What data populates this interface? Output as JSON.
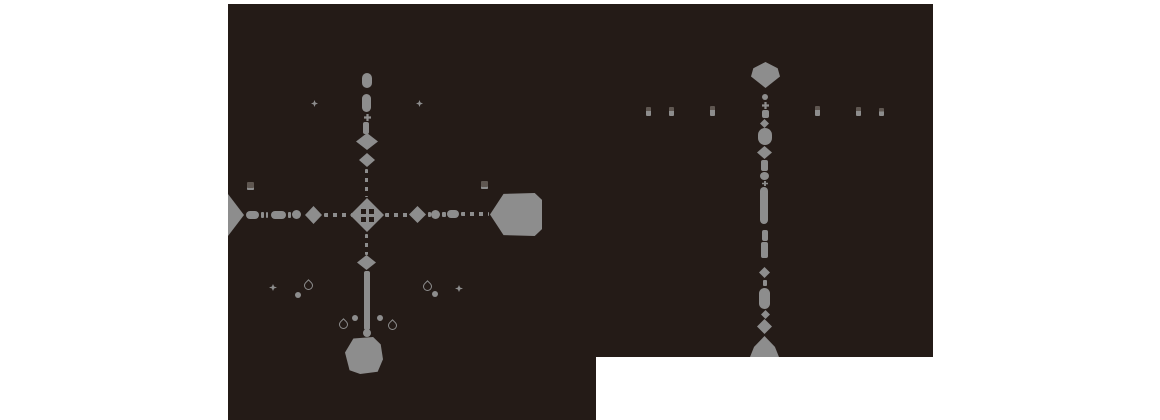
{
  "canvas": {
    "width": 1160,
    "height": 420
  },
  "colors": {
    "background": "#ffffff",
    "panel": "#241b17",
    "shape": "#8d8d8d",
    "dim": "#5f5751"
  },
  "panel": {
    "rects": [
      {
        "x": 228,
        "y": 4,
        "w": 705,
        "h": 353
      },
      {
        "x": 228,
        "y": 357,
        "w": 368,
        "h": 63
      }
    ]
  },
  "shapes": [
    {
      "t": "pill-v",
      "name": "left-route-north-terminal",
      "x": 362,
      "y": 73,
      "w": 10,
      "h": 15
    },
    {
      "t": "pill-v",
      "name": "left-route-segment",
      "x": 362,
      "y": 94,
      "w": 9,
      "h": 18
    },
    {
      "t": "plus",
      "name": "cross-node",
      "x": 364,
      "y": 114,
      "w": 7,
      "h": 7
    },
    {
      "t": "bar-v",
      "name": "left-route-segment",
      "x": 363,
      "y": 122,
      "w": 6,
      "h": 12
    },
    {
      "t": "diamond",
      "name": "route-node-diamond",
      "x": 356,
      "y": 133,
      "w": 22,
      "h": 17
    },
    {
      "t": "diamond",
      "name": "route-node-diamond",
      "x": 359,
      "y": 153,
      "w": 16,
      "h": 14
    },
    {
      "t": "dashes-v",
      "name": "dashed-path",
      "x": 365,
      "y": 169,
      "w": 3,
      "h": 28
    },
    {
      "t": "diamond-grid",
      "name": "left-route-center-junction",
      "x": 350,
      "y": 198,
      "w": 34,
      "h": 34
    },
    {
      "t": "dashes-v",
      "name": "dashed-path",
      "x": 365,
      "y": 234,
      "w": 3,
      "h": 21
    },
    {
      "t": "diamond",
      "name": "route-node-diamond",
      "x": 357,
      "y": 255,
      "w": 19,
      "h": 15
    },
    {
      "t": "bar-v",
      "name": "solid-path",
      "x": 364,
      "y": 271,
      "w": 6,
      "h": 59
    },
    {
      "t": "dot",
      "name": "route-node-dot",
      "x": 363,
      "y": 329,
      "w": 8,
      "h": 8
    },
    {
      "t": "tombstone",
      "name": "left-route-south-terminal",
      "x": 345,
      "y": 337,
      "w": 38,
      "h": 37
    },
    {
      "t": "tri-right",
      "name": "left-route-west-terminal",
      "x": 228,
      "y": 194,
      "w": 16,
      "h": 42
    },
    {
      "t": "pill-h",
      "name": "route-segment",
      "x": 246,
      "y": 211,
      "w": 13,
      "h": 8
    },
    {
      "t": "dash-h",
      "name": "route-dash",
      "x": 261,
      "y": 212,
      "w": 3,
      "h": 6
    },
    {
      "t": "dash-h",
      "name": "route-dash",
      "x": 266,
      "y": 212,
      "w": 2,
      "h": 6
    },
    {
      "t": "pill-h",
      "name": "route-segment",
      "x": 271,
      "y": 211,
      "w": 15,
      "h": 8
    },
    {
      "t": "dash-h",
      "name": "route-dash",
      "x": 288,
      "y": 212,
      "w": 3,
      "h": 6
    },
    {
      "t": "dot",
      "name": "route-node-dot",
      "x": 292,
      "y": 210,
      "w": 9,
      "h": 9
    },
    {
      "t": "diamond",
      "name": "route-node-diamond",
      "x": 305,
      "y": 206,
      "w": 17,
      "h": 18
    },
    {
      "t": "dashes-h",
      "name": "dashed-path",
      "x": 324,
      "y": 213,
      "w": 28,
      "h": 4
    },
    {
      "t": "dashes-h",
      "name": "dashed-path",
      "x": 385,
      "y": 213,
      "w": 24,
      "h": 4
    },
    {
      "t": "diamond",
      "name": "route-node-diamond",
      "x": 409,
      "y": 206,
      "w": 17,
      "h": 17
    },
    {
      "t": "dash-h",
      "name": "route-dash",
      "x": 428,
      "y": 212,
      "w": 3,
      "h": 5
    },
    {
      "t": "dot",
      "name": "route-node-dot",
      "x": 431,
      "y": 210,
      "w": 9,
      "h": 9
    },
    {
      "t": "dash-h",
      "name": "route-dash",
      "x": 442,
      "y": 212,
      "w": 4,
      "h": 5
    },
    {
      "t": "pill-h",
      "name": "route-segment",
      "x": 447,
      "y": 210,
      "w": 12,
      "h": 8
    },
    {
      "t": "dashes-h",
      "name": "dashed-path",
      "x": 461,
      "y": 212,
      "w": 28,
      "h": 4
    },
    {
      "t": "hex-left",
      "name": "left-route-east-terminal-hexagon",
      "x": 490,
      "y": 193,
      "w": 52,
      "h": 43
    },
    {
      "t": "star",
      "name": "star-marker-icon",
      "x": 311,
      "y": 100,
      "w": 7,
      "h": 7
    },
    {
      "t": "star",
      "name": "star-marker-icon",
      "x": 416,
      "y": 100,
      "w": 7,
      "h": 7
    },
    {
      "t": "building",
      "name": "building-marker-icon",
      "x": 247,
      "y": 182,
      "w": 7,
      "h": 8
    },
    {
      "t": "building",
      "name": "building-marker-icon",
      "x": 481,
      "y": 181,
      "w": 7,
      "h": 8
    },
    {
      "t": "star",
      "name": "star-marker-icon",
      "x": 269,
      "y": 284,
      "w": 8,
      "h": 7
    },
    {
      "t": "dot-s",
      "name": "dot-marker-icon",
      "x": 295,
      "y": 292,
      "w": 6,
      "h": 6
    },
    {
      "t": "drop",
      "name": "drop-marker-icon",
      "x": 304,
      "y": 281,
      "w": 9,
      "h": 9
    },
    {
      "t": "drop",
      "name": "drop-marker-icon",
      "x": 339,
      "y": 320,
      "w": 9,
      "h": 9
    },
    {
      "t": "dot-s",
      "name": "dot-marker-icon",
      "x": 352,
      "y": 315,
      "w": 6,
      "h": 6
    },
    {
      "t": "dot-s",
      "name": "dot-marker-icon",
      "x": 377,
      "y": 315,
      "w": 6,
      "h": 6
    },
    {
      "t": "drop",
      "name": "drop-marker-icon",
      "x": 388,
      "y": 321,
      "w": 9,
      "h": 9
    },
    {
      "t": "drop",
      "name": "drop-marker-icon",
      "x": 423,
      "y": 282,
      "w": 9,
      "h": 9
    },
    {
      "t": "dot-s",
      "name": "dot-marker-icon",
      "x": 432,
      "y": 291,
      "w": 6,
      "h": 6
    },
    {
      "t": "star",
      "name": "star-marker-icon",
      "x": 455,
      "y": 285,
      "w": 8,
      "h": 7
    },
    {
      "t": "hexagon",
      "name": "right-route-north-terminal-hexagon",
      "x": 751,
      "y": 62,
      "w": 29,
      "h": 26
    },
    {
      "t": "dot-s",
      "name": "route-node-dot",
      "x": 762,
      "y": 94,
      "w": 6,
      "h": 6
    },
    {
      "t": "plus",
      "name": "cross-node",
      "x": 762,
      "y": 102,
      "w": 7,
      "h": 7
    },
    {
      "t": "bar-v",
      "name": "route-segment",
      "x": 762,
      "y": 110,
      "w": 7,
      "h": 8
    },
    {
      "t": "diamond",
      "name": "route-node-diamond",
      "x": 760,
      "y": 119,
      "w": 9,
      "h": 9
    },
    {
      "t": "pill-v",
      "name": "route-segment",
      "x": 758,
      "y": 128,
      "w": 14,
      "h": 17
    },
    {
      "t": "diamond",
      "name": "route-node-diamond",
      "x": 757,
      "y": 146,
      "w": 15,
      "h": 13
    },
    {
      "t": "bar-v",
      "name": "route-segment",
      "x": 761,
      "y": 160,
      "w": 7,
      "h": 11
    },
    {
      "t": "dot",
      "name": "route-node-dot",
      "x": 760,
      "y": 172,
      "w": 9,
      "h": 8
    },
    {
      "t": "plus",
      "name": "cross-node",
      "x": 762,
      "y": 181,
      "w": 6,
      "h": 5
    },
    {
      "t": "pill-v",
      "name": "route-segment",
      "x": 760,
      "y": 187,
      "w": 8,
      "h": 37
    },
    {
      "t": "bar-v",
      "name": "route-segment",
      "x": 762,
      "y": 230,
      "w": 6,
      "h": 11
    },
    {
      "t": "bar-v",
      "name": "route-segment",
      "x": 761,
      "y": 242,
      "w": 7,
      "h": 16
    },
    {
      "t": "diamond",
      "name": "route-node-diamond",
      "x": 759,
      "y": 267,
      "w": 11,
      "h": 11
    },
    {
      "t": "dash-v",
      "name": "route-dash",
      "x": 763,
      "y": 280,
      "w": 4,
      "h": 6
    },
    {
      "t": "pill-v",
      "name": "route-segment",
      "x": 759,
      "y": 288,
      "w": 11,
      "h": 21
    },
    {
      "t": "diamond",
      "name": "route-node-diamond",
      "x": 761,
      "y": 310,
      "w": 9,
      "h": 9
    },
    {
      "t": "diamond",
      "name": "route-node-diamond",
      "x": 757,
      "y": 319,
      "w": 15,
      "h": 15
    },
    {
      "t": "hex-bottom",
      "name": "right-route-south-terminal-hexagon",
      "x": 750,
      "y": 336,
      "w": 29,
      "h": 21
    },
    {
      "t": "minimark",
      "name": "tick-marker-icon",
      "x": 646,
      "y": 107,
      "w": 5,
      "h": 9
    },
    {
      "t": "minimark",
      "name": "tick-marker-icon",
      "x": 669,
      "y": 107,
      "w": 5,
      "h": 9
    },
    {
      "t": "minimark",
      "name": "tick-marker-icon",
      "x": 710,
      "y": 106,
      "w": 5,
      "h": 10
    },
    {
      "t": "minimark",
      "name": "tick-marker-icon",
      "x": 815,
      "y": 106,
      "w": 5,
      "h": 10
    },
    {
      "t": "minimark",
      "name": "tick-marker-icon",
      "x": 856,
      "y": 107,
      "w": 5,
      "h": 9
    },
    {
      "t": "minimark",
      "name": "tick-marker-icon",
      "x": 879,
      "y": 108,
      "w": 5,
      "h": 8
    }
  ]
}
